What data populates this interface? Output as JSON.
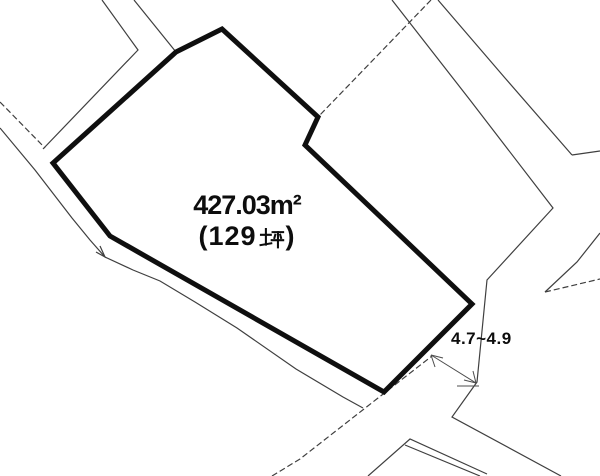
{
  "page": {
    "background": "#ffffff",
    "line_color": "#3f3f3f",
    "outline_color": "#0f0f0f",
    "dimension_color": "#4c4c4c"
  },
  "parcel": {
    "area_label": "427.03m²",
    "tsubo_label": "(129坪)",
    "tsubo_prefix": "(129",
    "tsubo_kanji": "坪",
    "tsubo_suffix": ")",
    "outline": [
      [
        222,
        29
      ],
      [
        318,
        117
      ],
      [
        305,
        145
      ],
      [
        472,
        304
      ],
      [
        384,
        392
      ],
      [
        110,
        236
      ],
      [
        53,
        163
      ],
      [
        176,
        52
      ]
    ]
  },
  "dimension": {
    "label": "4.7~4.9",
    "line": [
      431,
      355,
      476,
      383
    ],
    "ticks": [
      [
        431,
        355,
        443,
        358
      ],
      [
        431,
        355,
        435,
        367
      ],
      [
        476,
        383,
        464,
        380
      ],
      [
        476,
        383,
        473,
        371
      ],
      [
        457,
        386,
        479,
        386
      ]
    ]
  },
  "boundary_lines": [
    {
      "name": "road-edge-top-left-outer",
      "dashed": false,
      "points": [
        [
          102,
          0
        ],
        [
          138,
          50
        ],
        [
          43,
          149
        ]
      ]
    },
    {
      "name": "road-edge-top-left-inner",
      "dashed": false,
      "points": [
        [
          134,
          0
        ],
        [
          176,
          52
        ]
      ]
    },
    {
      "name": "road-edge-west-upper",
      "dashed": true,
      "points": [
        [
          0,
          102
        ],
        [
          45,
          148
        ]
      ]
    },
    {
      "name": "boundary-southwest",
      "dashed": false,
      "points": [
        [
          0,
          128
        ],
        [
          35,
          170
        ],
        [
          72,
          218
        ],
        [
          90,
          240
        ],
        [
          105,
          257
        ],
        [
          133,
          270
        ],
        [
          160,
          281
        ],
        [
          195,
          302
        ],
        [
          237,
          328
        ],
        [
          296,
          369
        ],
        [
          343,
          397
        ],
        [
          363,
          408
        ]
      ]
    },
    {
      "name": "boundary-southwest-arrowhead",
      "dashed": false,
      "points": [
        [
          96,
          252
        ],
        [
          105,
          257
        ],
        [
          100,
          246
        ]
      ]
    },
    {
      "name": "road-edge-north-diagonal",
      "dashed": true,
      "points": [
        [
          431,
          0
        ],
        [
          318,
          117
        ]
      ]
    },
    {
      "name": "road-edge-center-left",
      "dashed": false,
      "points": [
        [
          392,
          0
        ],
        [
          470,
          100
        ],
        [
          553,
          208
        ],
        [
          487,
          280
        ],
        [
          477,
          382
        ],
        [
          452,
          417
        ],
        [
          561,
          476
        ]
      ]
    },
    {
      "name": "road-edge-center-right",
      "dashed": false,
      "points": [
        [
          438,
          0
        ],
        [
          505,
          78
        ],
        [
          572,
          155
        ]
      ]
    },
    {
      "name": "road-branch-east",
      "dashed": false,
      "points": [
        [
          572,
          155
        ],
        [
          600,
          151
        ]
      ]
    },
    {
      "name": "parcel-line-east-upper",
      "dashed": false,
      "points": [
        [
          600,
          233
        ],
        [
          577,
          262
        ],
        [
          545,
          292
        ]
      ]
    },
    {
      "name": "parcel-line-east-lower",
      "dashed": true,
      "points": [
        [
          545,
          292
        ],
        [
          600,
          279
        ]
      ]
    },
    {
      "name": "boundary-south-diagonal",
      "dashed": true,
      "points": [
        [
          272,
          476
        ],
        [
          300,
          459
        ],
        [
          387,
          391
        ],
        [
          432,
          356
        ]
      ]
    },
    {
      "name": "road-fork-south",
      "dashed": false,
      "points": [
        [
          368,
          476
        ],
        [
          410,
          439
        ],
        [
          487,
          474
        ]
      ]
    },
    {
      "name": "road-fork-south-parallel",
      "dashed": false,
      "points": [
        [
          405,
          445
        ],
        [
          480,
          476
        ]
      ]
    }
  ]
}
